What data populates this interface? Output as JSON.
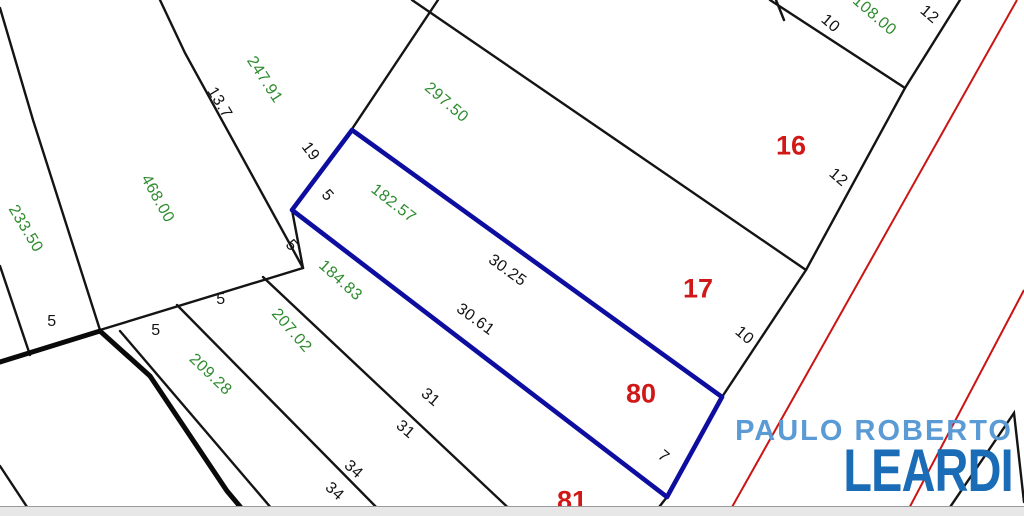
{
  "logo": {
    "line1": "PAULO ROBERTO",
    "line2": "LEARDI"
  },
  "colors": {
    "highlight_lot_outline": "#0d0da0",
    "road_axis_red": "#cc1414",
    "area_label_green": "#2e8b2e",
    "dimension_label_black": "#141414",
    "lot_number_red": "#d01818",
    "logo_light_blue": "#5b9bd5",
    "logo_dark_blue": "#1b6cb7",
    "scrollbar_gray": "#e7e7e7"
  },
  "map": {
    "highlighted_lot": {
      "number": "80",
      "area": "182.57",
      "sides": [
        "30.25",
        "30.61",
        "5",
        "7"
      ]
    },
    "labels": [
      {
        "text": "233.50",
        "kind": "area",
        "x": 25,
        "y": 229,
        "rot": 59
      },
      {
        "text": "468.00",
        "kind": "area",
        "x": 157,
        "y": 199,
        "rot": 61
      },
      {
        "text": "247.91",
        "kind": "area",
        "x": 264,
        "y": 80,
        "rot": 57
      },
      {
        "text": "297.50",
        "kind": "area",
        "x": 446,
        "y": 103,
        "rot": 41
      },
      {
        "text": "182.57",
        "kind": "area",
        "x": 393,
        "y": 204,
        "rot": 38
      },
      {
        "text": "184.83",
        "kind": "area",
        "x": 340,
        "y": 281,
        "rot": 42
      },
      {
        "text": "207.02",
        "kind": "area",
        "x": 291,
        "y": 331,
        "rot": 49
      },
      {
        "text": "209.28",
        "kind": "area",
        "x": 210,
        "y": 375,
        "rot": 44
      },
      {
        "text": "108.00",
        "kind": "area",
        "x": 874,
        "y": 16,
        "rot": 41
      },
      {
        "text": "13.7",
        "kind": "dim",
        "x": 219,
        "y": 103,
        "rot": 59
      },
      {
        "text": "19",
        "kind": "dim",
        "x": 310,
        "y": 152,
        "rot": 53
      },
      {
        "text": "5",
        "kind": "dim",
        "x": 327,
        "y": 196,
        "rot": 48
      },
      {
        "text": "5",
        "kind": "dim",
        "x": 291,
        "y": 246,
        "rot": 48
      },
      {
        "text": "5",
        "kind": "dim",
        "x": 52,
        "y": 322,
        "rot": 0
      },
      {
        "text": "5",
        "kind": "dim",
        "x": 156,
        "y": 331,
        "rot": 0
      },
      {
        "text": "5",
        "kind": "dim",
        "x": 221,
        "y": 300,
        "rot": 0
      },
      {
        "text": "30.25",
        "kind": "dim",
        "x": 507,
        "y": 271,
        "rot": 36
      },
      {
        "text": "30.61",
        "kind": "dim",
        "x": 475,
        "y": 320,
        "rot": 36
      },
      {
        "text": "31",
        "kind": "dim",
        "x": 430,
        "y": 398,
        "rot": 40
      },
      {
        "text": "31",
        "kind": "dim",
        "x": 405,
        "y": 430,
        "rot": 40
      },
      {
        "text": "34",
        "kind": "dim",
        "x": 353,
        "y": 470,
        "rot": 42
      },
      {
        "text": "34",
        "kind": "dim",
        "x": 334,
        "y": 492,
        "rot": 42
      },
      {
        "text": "10",
        "kind": "dim",
        "x": 830,
        "y": 24,
        "rot": 40
      },
      {
        "text": "12",
        "kind": "dim",
        "x": 929,
        "y": 15,
        "rot": 40
      },
      {
        "text": "12",
        "kind": "dim",
        "x": 838,
        "y": 178,
        "rot": 40
      },
      {
        "text": "10",
        "kind": "dim",
        "x": 744,
        "y": 336,
        "rot": 40
      },
      {
        "text": "7",
        "kind": "dim",
        "x": 663,
        "y": 457,
        "rot": 40
      },
      {
        "text": "16",
        "kind": "lot",
        "x": 791,
        "y": 146,
        "rot": 0
      },
      {
        "text": "17",
        "kind": "lot",
        "x": 698,
        "y": 289,
        "rot": 0
      },
      {
        "text": "80",
        "kind": "lot",
        "x": 641,
        "y": 394,
        "rot": 0
      },
      {
        "text": "81",
        "kind": "lot",
        "x": 572,
        "y": 501,
        "rot": 0
      }
    ]
  }
}
